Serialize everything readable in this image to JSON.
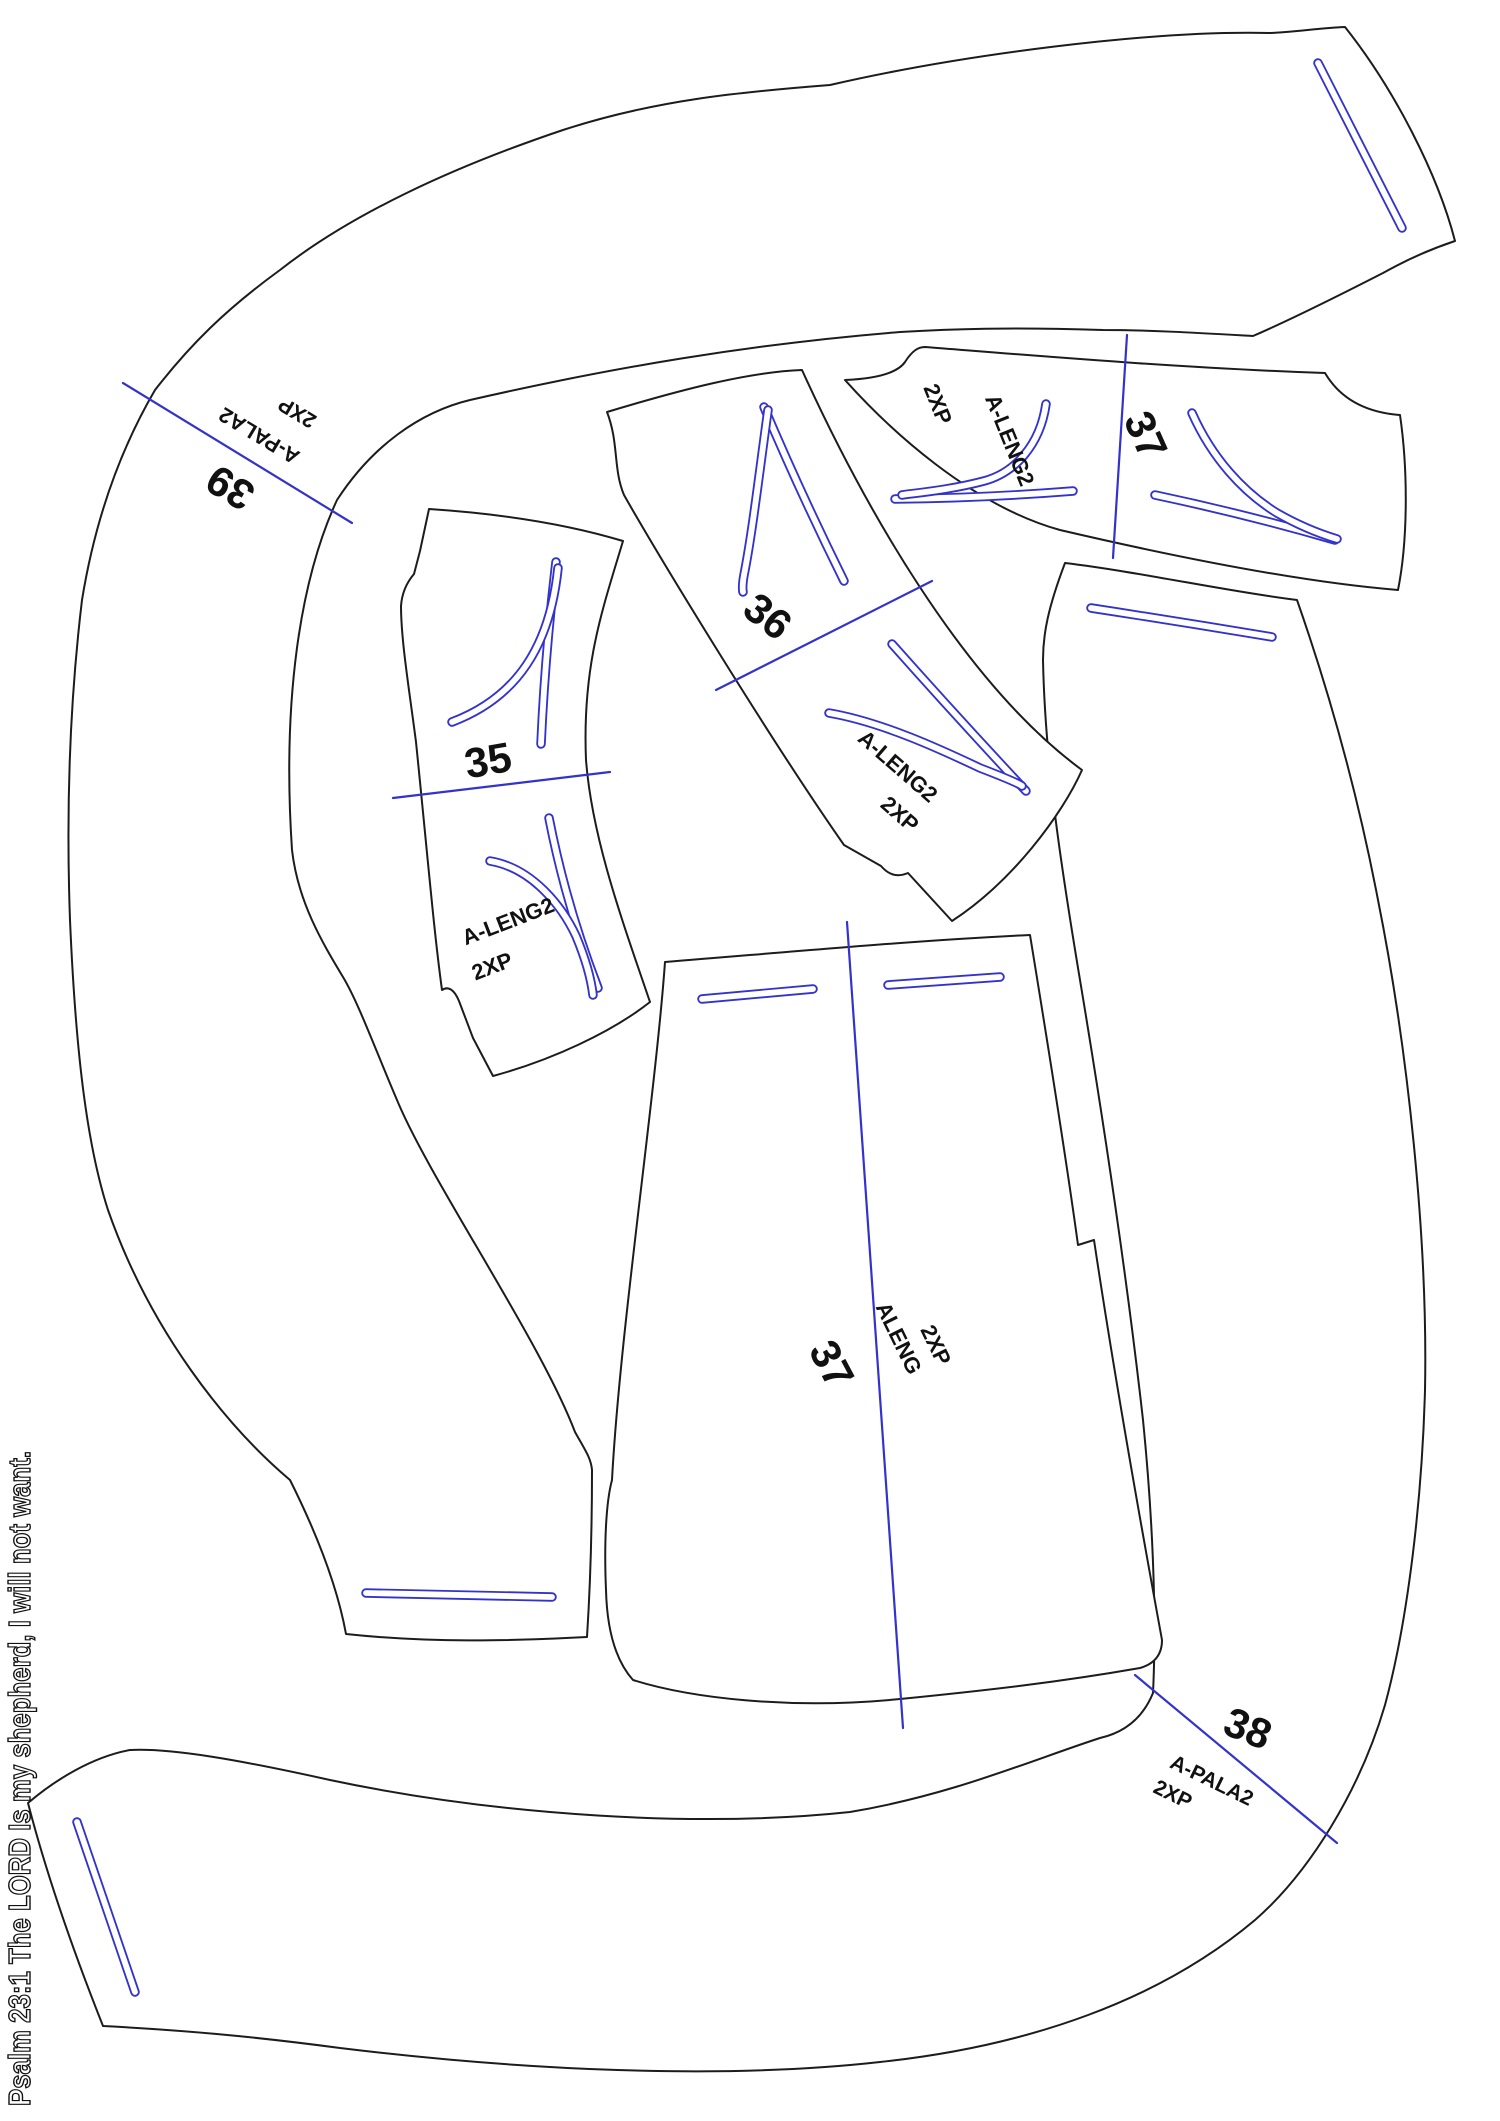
{
  "document": {
    "type": "sewing-pattern-marker-layout",
    "background": "#ffffff",
    "outline_color": "#1c1c1c",
    "mark_color": "#3333cc",
    "text_color": "#111111"
  },
  "margin_text": "Psalm 23:1 The LORD Is my shepherd, I will not want.",
  "pieces": {
    "p39": {
      "size": "39",
      "name": "A-PALA2",
      "qty": "2XP"
    },
    "p38": {
      "size": "38",
      "name": "A-PALA2",
      "qty": "2XP"
    },
    "p35": {
      "size": "35",
      "name": "A-LENG2",
      "qty": "2XP"
    },
    "p36": {
      "size": "36",
      "name": "A-LENG2",
      "qty": "2XP"
    },
    "p37yoke": {
      "size": "37",
      "name": "A-LENG2",
      "qty": "2XP"
    },
    "p37panel": {
      "size": "37",
      "name": "ALENG",
      "qty": "2XP"
    }
  }
}
